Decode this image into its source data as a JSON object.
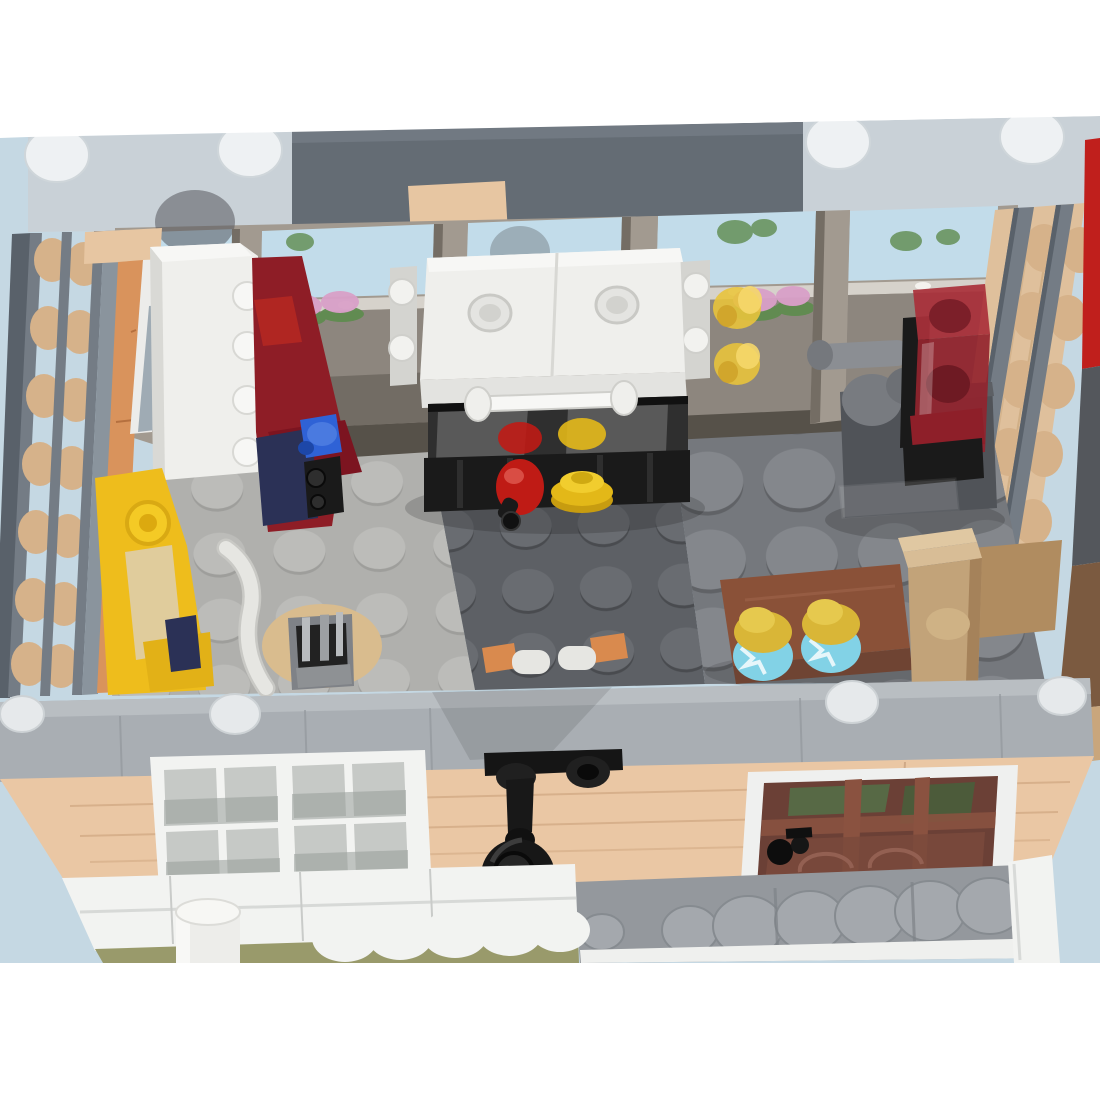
{
  "scene": {
    "type": "lego-render",
    "description": "Overhead render of a LEGO modular building interior room (kitchen/shop) with open roof, rear window wall, stove, cabinets, display tank, jar table, and street facade with lantern and door at the front",
    "objects": [
      "top-edge-plates",
      "rear-window-wall",
      "flower-boxes",
      "left-log-wall",
      "right-log-wall",
      "white-cabinet",
      "red-cabinet",
      "blue-faucet",
      "yellow-bench",
      "white-hose",
      "round-rug",
      "rug-machine",
      "stove-oven",
      "red-kettle",
      "yellow-dish-stack",
      "trans-yellow-bottles",
      "display-tank",
      "gray-faucet-arm",
      "glass-tile",
      "brown-table",
      "storage-jars",
      "tan-box",
      "towel-rail",
      "front-wall-band",
      "street-facade",
      "facade-windows",
      "wall-lantern",
      "glass-door",
      "sidewalk-studs",
      "clapboard-band",
      "olive-awning",
      "awning-scallops",
      "white-pipe",
      "corner-pillar"
    ]
  },
  "palette": {
    "page_bg": "#ffffff",
    "backdrop": "#c5d8e3",
    "top_plate": "#c9d1d7",
    "top_plate_stud": "#eef1f3",
    "top_dark_plate": "#646c74",
    "lintel_tan": "#e7c6a2",
    "win_frame": "#a29a90",
    "win_frame_dark": "#746d64",
    "win_sky": "#c2dcea",
    "win_glass": "#8d867e",
    "win_glass_dark": "#6b655e",
    "sill": "#d6d2cb",
    "foliage": "#5f8c4f",
    "flowers": "#d9a0c8",
    "wall_tan": "#dfc09c",
    "wall_tan_dark": "#c9a67c",
    "disc_tan": "#d6b28a",
    "technic_gray": "#747c85",
    "technic_dark": "#59616a",
    "side_gray": "#8a949d",
    "orange_wall": "#d9935c",
    "red_edge": "#c01f1c",
    "floor_light": "#b0b0ad",
    "floor_light_stud": "#bcbcb9",
    "floor_dark": "#5d6065",
    "floor_dark_stud": "#696c71",
    "floor_mid": "#75787d",
    "floor_mid_stud": "#84878c",
    "band_gray": "#a9aeb3",
    "band_lip": "#b9bec2",
    "band_stud": "#e6e9eb",
    "white_furniture": "#efefec",
    "white_top": "#f7f7f5",
    "white_shadow": "#d9d9d5",
    "red_dark": "#8e1d26",
    "red_bright": "#b02622",
    "navy": "#2b3156",
    "blue_piece": "#2f62d6",
    "black_part": "#1a1a1a",
    "glass_dark": "#2f2f2f",
    "kettle_red": "#bf1b15",
    "dish_yellow": "#e3b818",
    "trans_yellow": "#e8c33c",
    "tank_red": "#a93039",
    "tank_red_dark": "#7c1f29",
    "table_gray": "#505358",
    "brown_table": "#8a5138",
    "box_tan": "#c2a379",
    "box_tan_light": "#d8bd96",
    "jar_glass": "#82d2e6",
    "jar_lid": "#d9b637",
    "facade_tan": "#eac7a4",
    "door_brown": "#6b4036",
    "door_green": "#4f7a4b",
    "sidewalk": "#94989d",
    "sidewalk_stud": "#a4a8ad",
    "clapboard": "#f2f3f1",
    "olive": "#999a6b",
    "gold": "#c2a24e",
    "bench_yellow": "#eebd1c",
    "bench_cushion": "#e0cc9c",
    "rug_tan": "#d9bc8e",
    "machine_gray": "#7f8287",
    "hose_white": "#e6e6e2",
    "pad_orange": "#d98a4e"
  }
}
